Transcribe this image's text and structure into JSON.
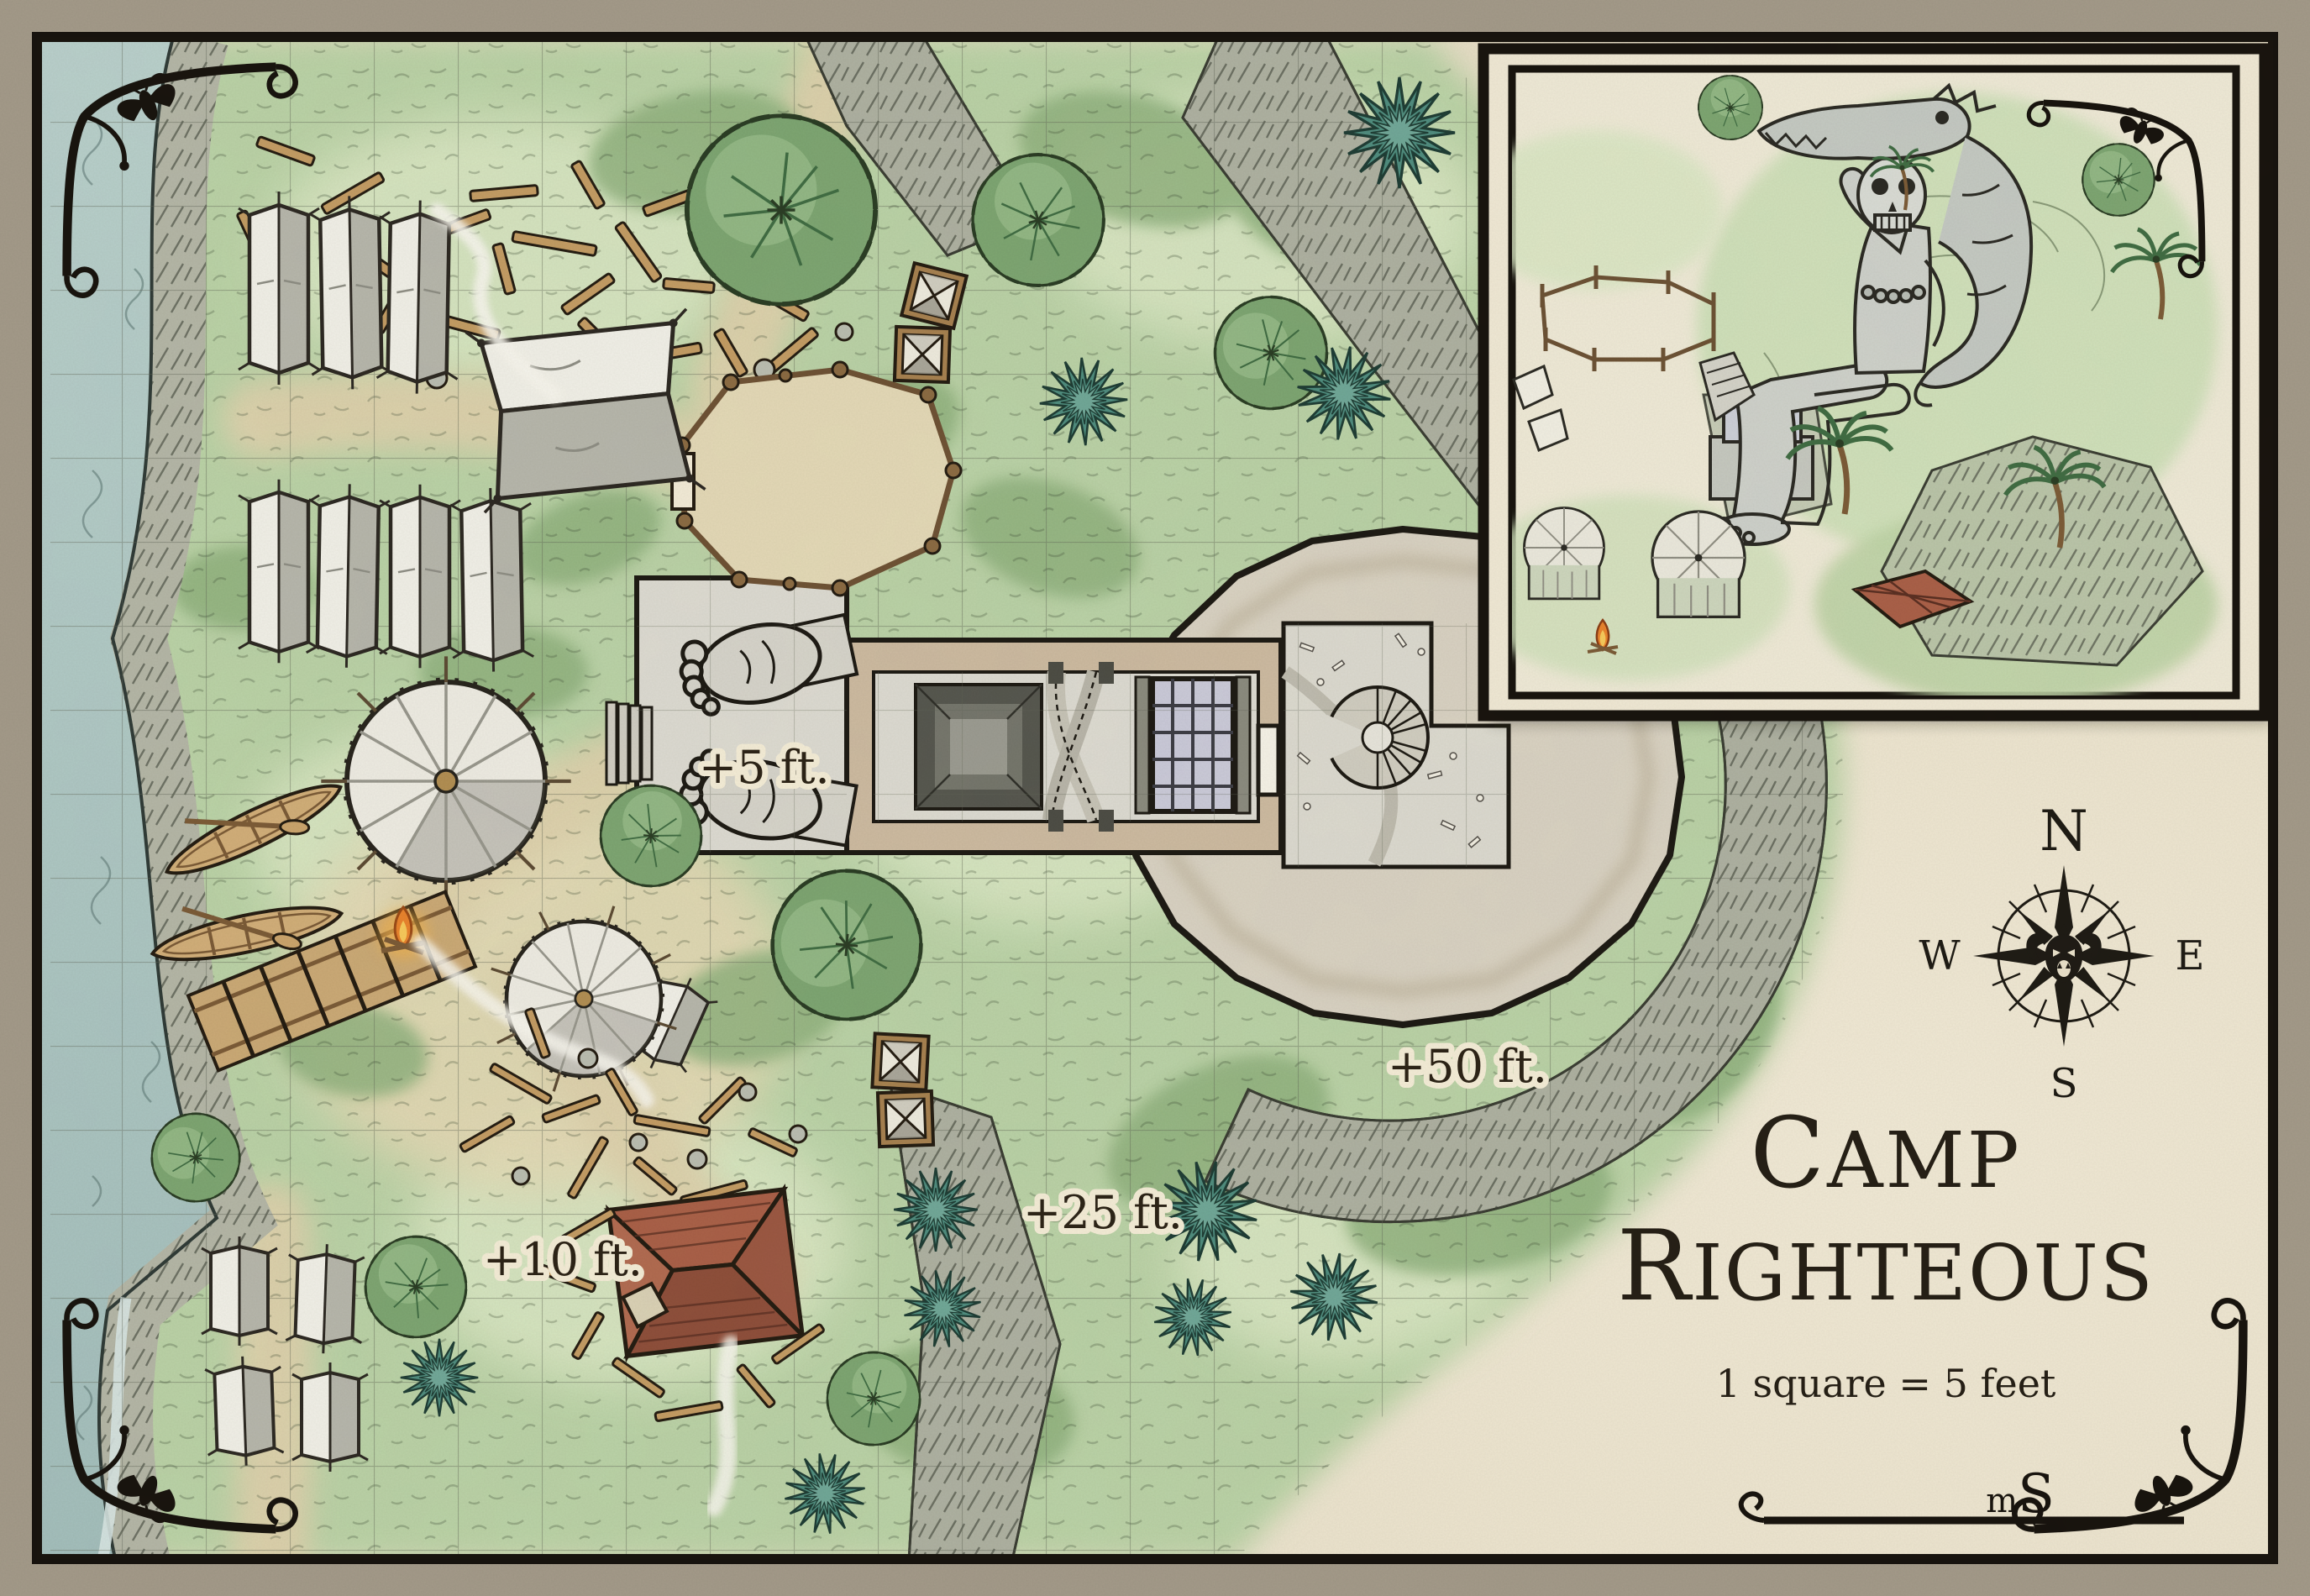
{
  "map": {
    "name": "battle-map",
    "title": "Camp Righteous",
    "title_line1": "Camp",
    "title_line2": "Righteous",
    "title_line1_initial": "C",
    "title_line1_rest": "AMP",
    "title_line2_initial": "R",
    "title_line2_rest": "IGHTEOUS",
    "scale_text": "1 square = 5 feet",
    "grid_note": "square grid, 1 square = 5 feet"
  },
  "labels": {
    "elev_platform": "+5 ft.",
    "elev_camp": "+10 ft.",
    "elev_mid_ridge": "+25 ft.",
    "elev_high_ridge": "+50 ft."
  },
  "compass": {
    "north": "N",
    "east": "E",
    "south": "S",
    "west": "W"
  },
  "signature": {
    "m": "m",
    "s": "S"
  },
  "colors": {
    "outer_margin": "#a39a89",
    "parchment": "#e9e1ca",
    "frame_ink": "#17130e",
    "grass_green": "#b9d1a6",
    "scrub_green": "#8fb07e",
    "water_blue": "#aec7c4",
    "rock_grey": "#adb0a1",
    "stone_light": "#dcdad1",
    "stone_wall": "#cbb9a0",
    "plateau_stone": "#d8d1c2",
    "tent_canvas": "#f0efe7",
    "tent_shadow": "#b5b5ab",
    "wood_brown": "#c29b63",
    "roof_red": "#a85f47",
    "teal_plant": "#4e8b7d",
    "fire_orange": "#e8822c",
    "grate_lavender": "#c9c9d8"
  },
  "features": [
    "river",
    "rocky-shore",
    "boats",
    "dock-ladder",
    "ridge-tents",
    "round-pavilions",
    "command-pavilion",
    "corral",
    "supply-crates",
    "lumber-debris",
    "campfires",
    "ruined-building",
    "jungle-trees",
    "teal-ferns",
    "stone-temple",
    "giant-statue-feet",
    "sunken-pit",
    "floor-grate",
    "spiral-staircase",
    "stone-plateau",
    "rock-ridges",
    "grid-overlay",
    "inset-perspective-view",
    "compass-rose"
  ]
}
